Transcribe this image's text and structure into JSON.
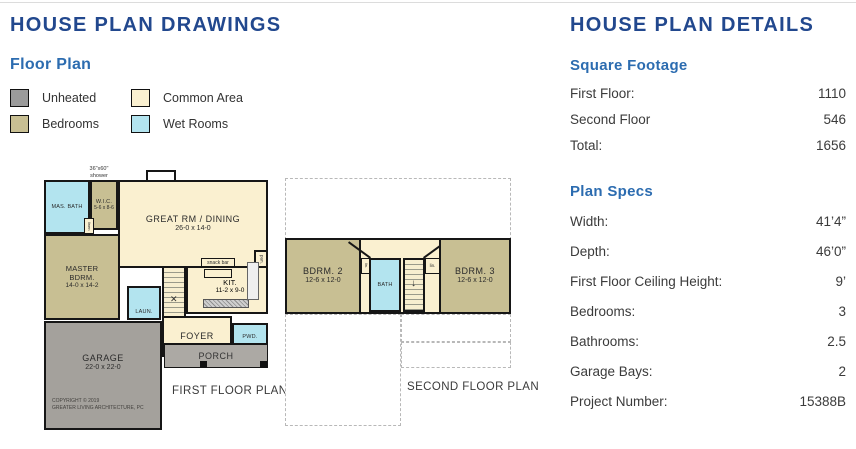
{
  "left": {
    "title": "HOUSE PLAN DRAWINGS",
    "subtitle": "Floor Plan",
    "legend": [
      {
        "label": "Unheated",
        "color": "#9B9B9B"
      },
      {
        "label": "Bedrooms",
        "color": "#C8BF93"
      },
      {
        "label": "Common Area",
        "color": "#FAF0D0"
      },
      {
        "label": "Wet Rooms",
        "color": "#B3E4EF"
      }
    ]
  },
  "first_floor": {
    "caption": "FIRST FLOOR PLAN",
    "shower_note_line1": "36\"x60\"",
    "shower_note_line2": "shower",
    "rooms": {
      "mas_bath": "MAS. BATH",
      "wic": "W.I.C.",
      "wic_dims": "5-6 x 8-6",
      "linen": "linen",
      "great": "GREAT RM / DINING",
      "great_dims": "26-0 x 14-0",
      "master": "MASTER BDRM.",
      "master_dims": "14-0 x 14-2",
      "laundry": "LAUN.",
      "kitchen": "KIT.",
      "kitchen_dims": "11-2 x 9-0",
      "snack_bar": "snack bar",
      "pantry": "pan.",
      "foyer": "FOYER",
      "powder": "PWD.",
      "garage": "GARAGE",
      "garage_dims": "22-0 x 22-0",
      "porch": "PORCH"
    },
    "copyright_line1": "COPYRIGHT © 2019",
    "copyright_line2": "GREATER LIVING ARCHITECTURE, PC"
  },
  "second_floor": {
    "caption": "SECOND FLOOR PLAN",
    "rooms": {
      "bdrm2": "BDRM. 2",
      "bdrm2_dims": "12-6 x 12-0",
      "bath": "BATH",
      "linen_left": "lin.",
      "linen_right": "lin.",
      "bdrm3": "BDRM. 3",
      "bdrm3_dims": "12-6 x 12-0"
    }
  },
  "details": {
    "title": "HOUSE PLAN DETAILS",
    "square_footage": {
      "heading": "Square Footage",
      "rows": [
        {
          "label": "First Floor:",
          "value": "1110"
        },
        {
          "label": "Second Floor",
          "value": "546"
        },
        {
          "label": "Total:",
          "value": "1656"
        }
      ]
    },
    "plan_specs": {
      "heading": "Plan Specs",
      "rows": [
        {
          "label": "Width:",
          "value": "41’4”"
        },
        {
          "label": "Depth:",
          "value": "46’0”"
        },
        {
          "label": "First Floor Ceiling Height:",
          "value": "9’"
        },
        {
          "label": "Bedrooms:",
          "value": "3"
        },
        {
          "label": "Bathrooms:",
          "value": "2.5"
        },
        {
          "label": "Garage Bays:",
          "value": "2"
        },
        {
          "label": "Project Number:",
          "value": "15388B"
        }
      ]
    }
  },
  "colors": {
    "title_navy": "#22488E",
    "heading_blue": "#2C6CB0",
    "wall": "#161616",
    "unheated": "#9B9B9B",
    "bedrooms": "#C8BF93",
    "common_area": "#FAF0D0",
    "wet_rooms": "#B3E4EF"
  }
}
